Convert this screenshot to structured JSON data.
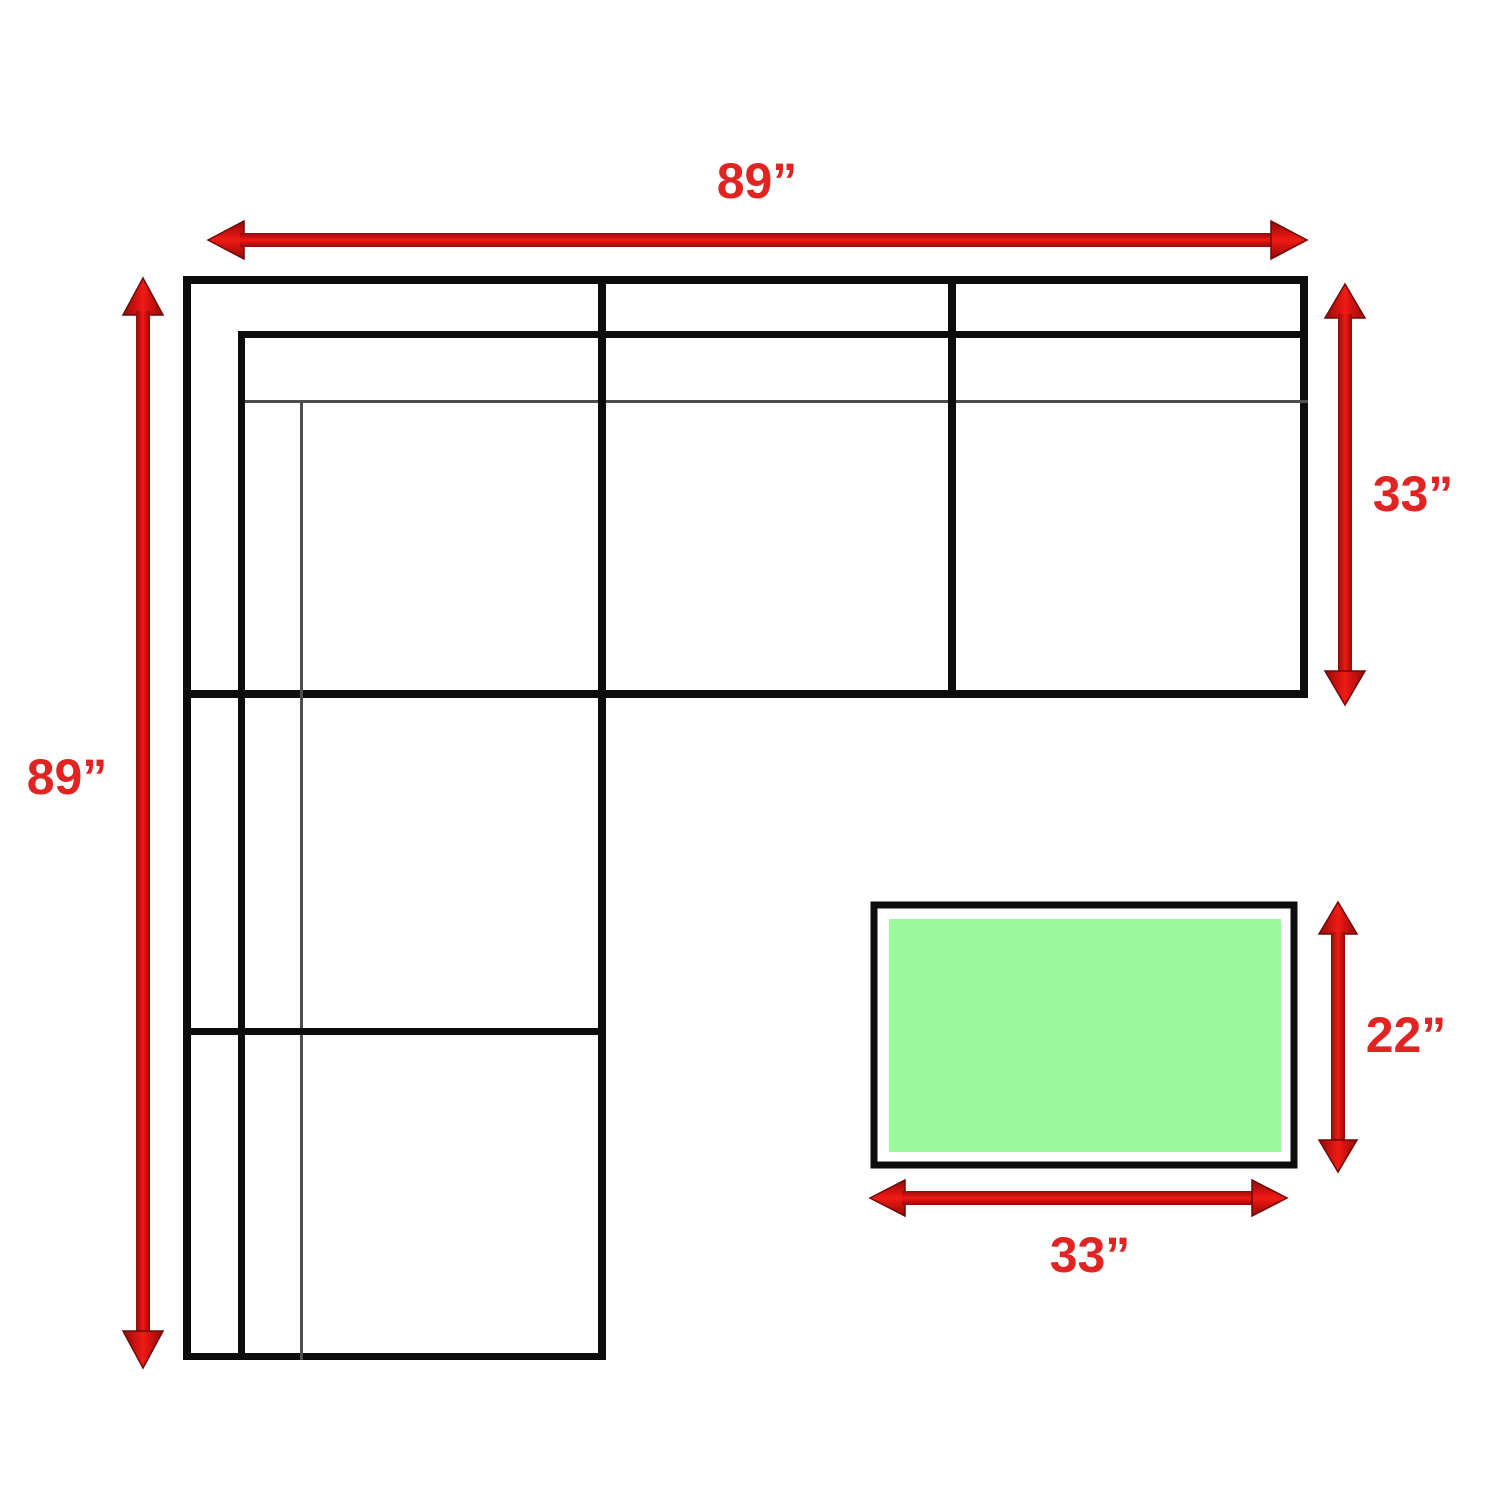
{
  "diagram": {
    "type": "sectional-sofa-dimension-diagram",
    "labels": {
      "sofa_width": "89”",
      "sofa_depth_left": "89”",
      "sofa_section_depth": "33”",
      "ottoman_depth": "22”",
      "ottoman_width": "33”"
    },
    "colors": {
      "arrow_red": "#D61310",
      "arrow_red_bright": "#F01B16",
      "arrow_dark_red": "#8E0D0B",
      "label_red": "#E12421",
      "outline_black": "#0D0D0D",
      "thin_line_gray": "#4D4D4D",
      "ottoman_green": "#9BFA9E",
      "background": "#FFFFFF"
    }
  }
}
